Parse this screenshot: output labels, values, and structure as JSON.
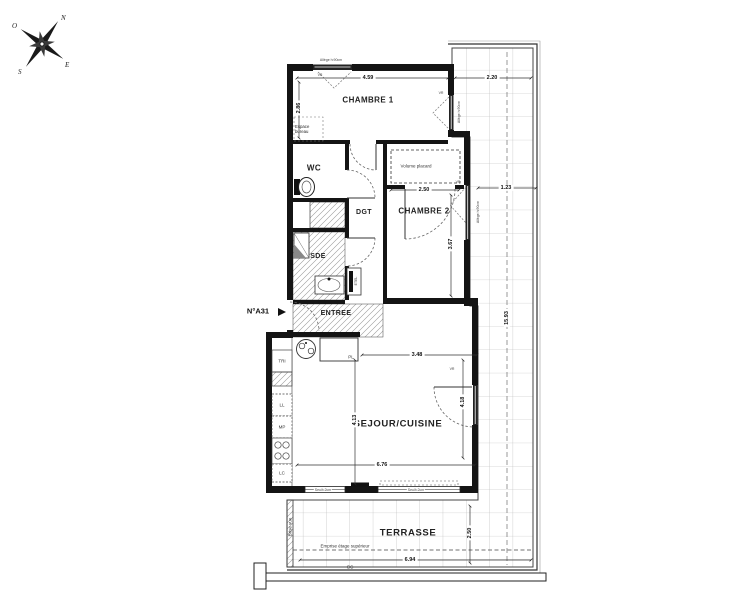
{
  "compass": {
    "n": "N",
    "e": "E",
    "s": "S",
    "o": "O"
  },
  "unit": {
    "number": "N°A31"
  },
  "rooms": {
    "chambre1": "CHAMBRE 1",
    "wc": "WC",
    "dgt": "DGT",
    "chambre2": "CHAMBRE 2",
    "sde": "SDE",
    "entree": "ENTREE",
    "sejour": "SEJOUR/CUISINE",
    "terrasse": "TERRASSE"
  },
  "annotations": {
    "espace_bureau": "Espace bureau",
    "volume_placard": "Volume placard",
    "emprise": "Emprise étage supérieur",
    "brise_vue": "Brise vue",
    "gc": "GC",
    "etel": "ETEL",
    "pl": "PL",
    "tri": "TRI",
    "ll": "LL",
    "mp": "MP",
    "lc": "LC",
    "vr": "VR",
    "allege": "Allège h:90cm",
    "seuil": "Seuil<2cm"
  },
  "dimensions": {
    "chambre1_w": "4.59",
    "chambre1_h": "2.86",
    "terrasse_top": "2.20",
    "terrasse_right": "1.23",
    "chambre2_w": "2.50",
    "chambre2_h": "3.67",
    "sejour_top": "3.48",
    "sejour_left": "4.13",
    "sejour_right": "4.18",
    "sejour_w": "6.76",
    "terrasse_h": "15.93",
    "terrasse_w": "6.94",
    "terrasse_depth": "2.50"
  }
}
